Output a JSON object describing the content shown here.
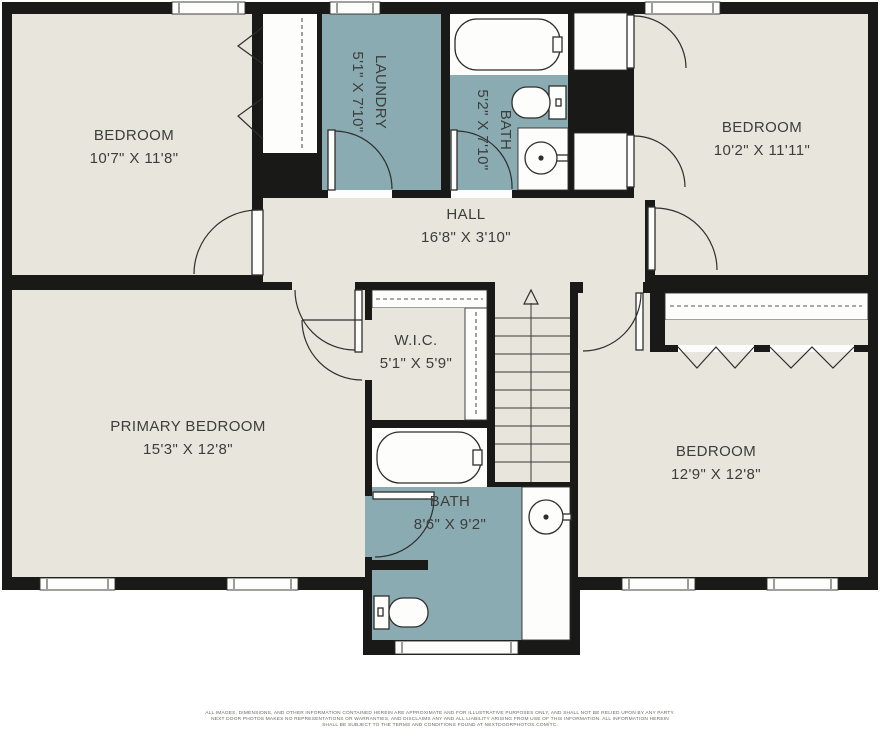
{
  "colors": {
    "wall": "#191917",
    "floor": "#e8e5dc",
    "wet": "#8aabb2",
    "white": "#fdfdfc",
    "line": "#2e2e2c",
    "text": "#3d3d3b"
  },
  "rooms": {
    "bedroom_tl": {
      "name": "BEDROOM",
      "dims": "10'7\" X 11'8\""
    },
    "laundry": {
      "name": "LAUNDRY",
      "dims": "5'1\" X 7'10\""
    },
    "bath_top": {
      "name": "BATH",
      "dims": "5'2\" X 7'10\""
    },
    "bedroom_tr": {
      "name": "BEDROOM",
      "dims": "10'2\" X 11'11\""
    },
    "hall": {
      "name": "HALL",
      "dims": "16'8\" X 3'10\""
    },
    "wic": {
      "name": "W.I.C.",
      "dims": "5'1\" X 5'9\""
    },
    "primary_bedroom": {
      "name": "PRIMARY BEDROOM",
      "dims": "15'3\" X 12'8\""
    },
    "bath_bottom": {
      "name": "BATH",
      "dims": "8'6\" X 9'2\""
    },
    "bedroom_br": {
      "name": "BEDROOM",
      "dims": "12'9\" X 12'8\""
    }
  },
  "disclaimer": {
    "line1": "ALL IMAGES, DIMENSIONS, AND OTHER INFORMATION CONTAINED HEREIN ARE APPROXIMATE AND FOR ILLUSTRATIVE PURPOSES ONLY, AND SHALL NOT BE RELIED UPON BY ANY PARTY.",
    "line2": "NEXT DOOR PHOTOS MAKES NO REPRESENTATIONS OR WARRANTIES, AND DISCLAIMS ANY AND ALL LIABILITY ARISING FROM USE OF THIS INFORMATION. ALL INFORMATION HEREIN",
    "line3": "SHALL BE SUBJECT TO THE TERMS AND CONDITIONS FOUND AT NEXTDOORPHOTOS.COM/TC."
  }
}
